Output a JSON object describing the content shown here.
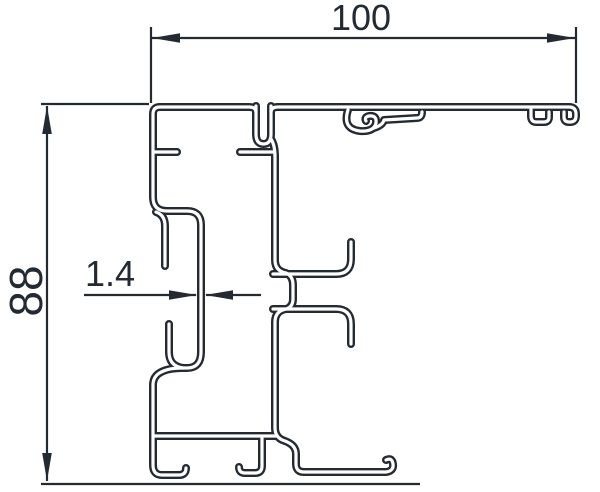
{
  "drawing": {
    "kind": "aluminium profile cross-section",
    "colors": {
      "line": "#242a33",
      "background": "#ffffff"
    },
    "dimensions": {
      "width": {
        "label": "100"
      },
      "height": {
        "label": "88"
      },
      "thickness": {
        "label": "1.4"
      }
    }
  }
}
